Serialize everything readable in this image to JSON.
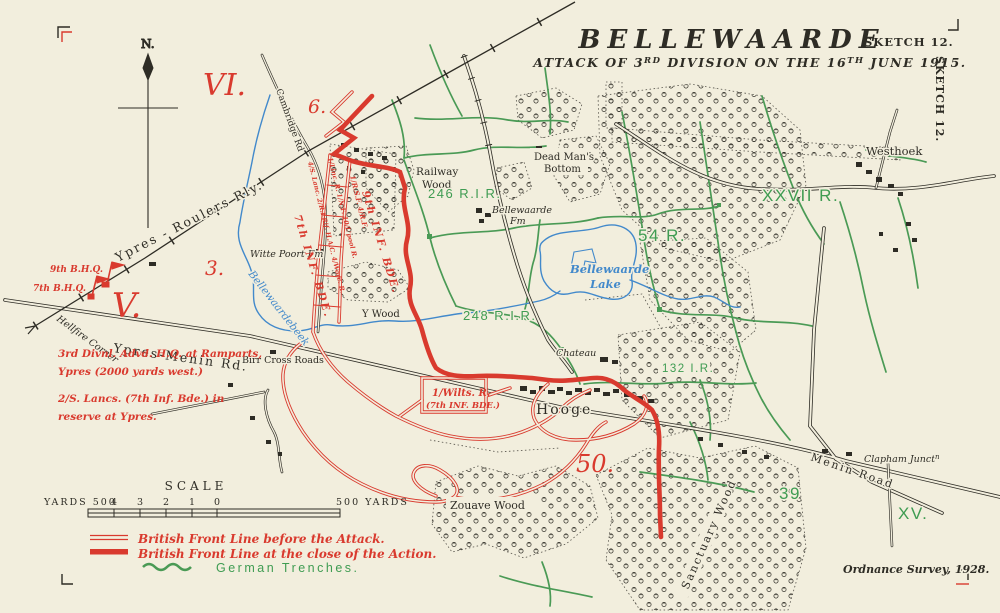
{
  "colors": {
    "paper": "#f2eedd",
    "ink": "#2e2c25",
    "red": "#d93a2e",
    "green": "#4a9a55",
    "blue": "#4289cb"
  },
  "header": {
    "title": "BELLEWAARDE",
    "sketch_no": "SKETCH 12.",
    "side_sketch": "SKETCH 12.",
    "subtitle": {
      "t1": "ATTACK OF 3",
      "s1": "RD",
      "t2": " DIVISION ON THE 16",
      "s2": "TH",
      "t3": " JUNE 1915."
    }
  },
  "compass": {
    "north": "N."
  },
  "map_labels": {
    "roads": {
      "ypres_roulers": "Ypres - Roulers Rly.",
      "ypres_menin": "Ypres-Menin Rd.",
      "menin_road": "Menin Road",
      "cambridge": "Cambridge Rd",
      "hellfire": "Hellfire Corner"
    },
    "places": {
      "railway_wood_l1": "Railway",
      "railway_wood_l2": "Wood",
      "y_wood": "Y Wood",
      "dead_mans_l1": "Dead Man's",
      "dead_mans_l2": "Bottom",
      "witte_poort": "Witte Poort Fm",
      "bellewaarde_fm_l1": "Bellewaarde",
      "bellewaarde_fm_l2": "Fm",
      "birr": "Birr Cross Roads",
      "chateau": "Chateau",
      "hooge": "Hooge",
      "westhoek": "Westhoek",
      "clapham": "Clapham Junct",
      "clapham_sup": "n",
      "zouave": "Zouave Wood",
      "sanctuary": "Sanctuary Wood",
      "lake_l1": "Bellewaarde",
      "lake_l2": "Lake",
      "beek": "Bellewaardebeek"
    },
    "german_units": {
      "rir246": "246 R.I.R.",
      "rir248": "248 R.I.R.",
      "r54": "54 R.",
      "xxvii": "XXVII R.",
      "ir132": "132 I.R.",
      "n39": "39",
      "xv": "XV."
    },
    "sectors": {
      "vi": "VI.",
      "v": "V.",
      "n3": "3.",
      "n6": "6.",
      "n50": "50."
    },
    "british": {
      "bhq9": "9th B.H.Q.",
      "bhq7": "7th B.H.Q.",
      "inf9": "9th INF. BDE.",
      "inf7": "7th INF. BDE.",
      "units_a": "4/S. Lanc.  2/R.I.Rif.  H.A.C.  4/Worc. R.",
      "units_b": "1/Linc. R.  1/N.F.  10/L'pool R.",
      "units_c": "1/R.S.F.  4/R.F.",
      "wilts_l1": "1/Wilts. R.",
      "wilts_l2": "(7th INF. BDE.)",
      "note1_l1": "3rd Divnl. Advd. H.Q. at Ramparts,",
      "note1_l2": "Ypres (2000 yards west.)",
      "note2_l1": "2/S. Lancs. (7th Inf. Bde.) in",
      "note2_l2": "reserve at Ypres."
    }
  },
  "scale": {
    "title": "SCALE",
    "left_label": "YARDS 500",
    "ticks": [
      "4",
      "3",
      "2",
      "1",
      "0"
    ],
    "right_label": "500 YARDS"
  },
  "legend": {
    "items": [
      {
        "symbol": "double-red-line",
        "label": "British Front Line before the Attack."
      },
      {
        "symbol": "thick-red-line",
        "label": "British Front Line at the close of the Action."
      },
      {
        "symbol": "green-wavy-line",
        "label": "German Trenches."
      }
    ]
  },
  "credits": {
    "ordnance": "Ordnance Survey, 1928."
  }
}
